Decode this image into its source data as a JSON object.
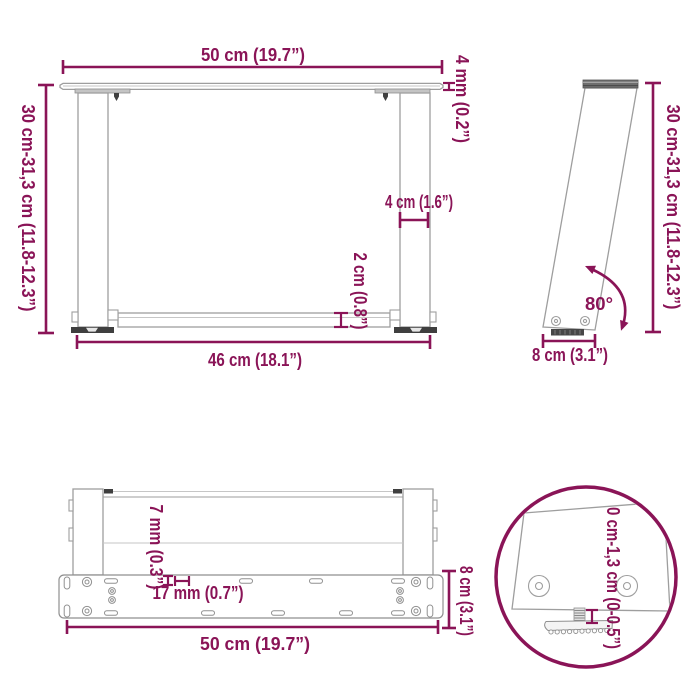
{
  "document": {
    "kind": "furniture-dimension-diagram",
    "subject": "U-shaped coffee table legs technical drawing"
  },
  "colors": {
    "accent": "#8A1457",
    "drawing_line": "#9E9E9E",
    "dark_metal": "#3F3F3F",
    "background": "#FFFFFF"
  },
  "front_view": {
    "top_width": "50 cm (19.7”)",
    "plate_thickness": "4 mm (0.2”)",
    "height_range": "30 cm-31,3 cm (11.8-12.3”)",
    "leg_width": "4 cm (1.6”)",
    "crossbar_height": "2 cm (0.8”)",
    "outer_leg_span": "46 cm (18.1”)"
  },
  "side_view": {
    "height_range": "30 cm-31,3 cm (11.8-12.3”)",
    "angle": "80°",
    "foot_depth": "8 cm (3.1”)"
  },
  "bottom_view": {
    "hole_diameter": "7 mm (0.3”)",
    "hole_spacing": "17 mm (0.7”)",
    "plate_depth": "8 cm (3.1”)",
    "plate_width": "50 cm (19.7”)"
  },
  "detail_view": {
    "adjustable_range": "0 cm-1,3 cm (0-0.5”)"
  }
}
